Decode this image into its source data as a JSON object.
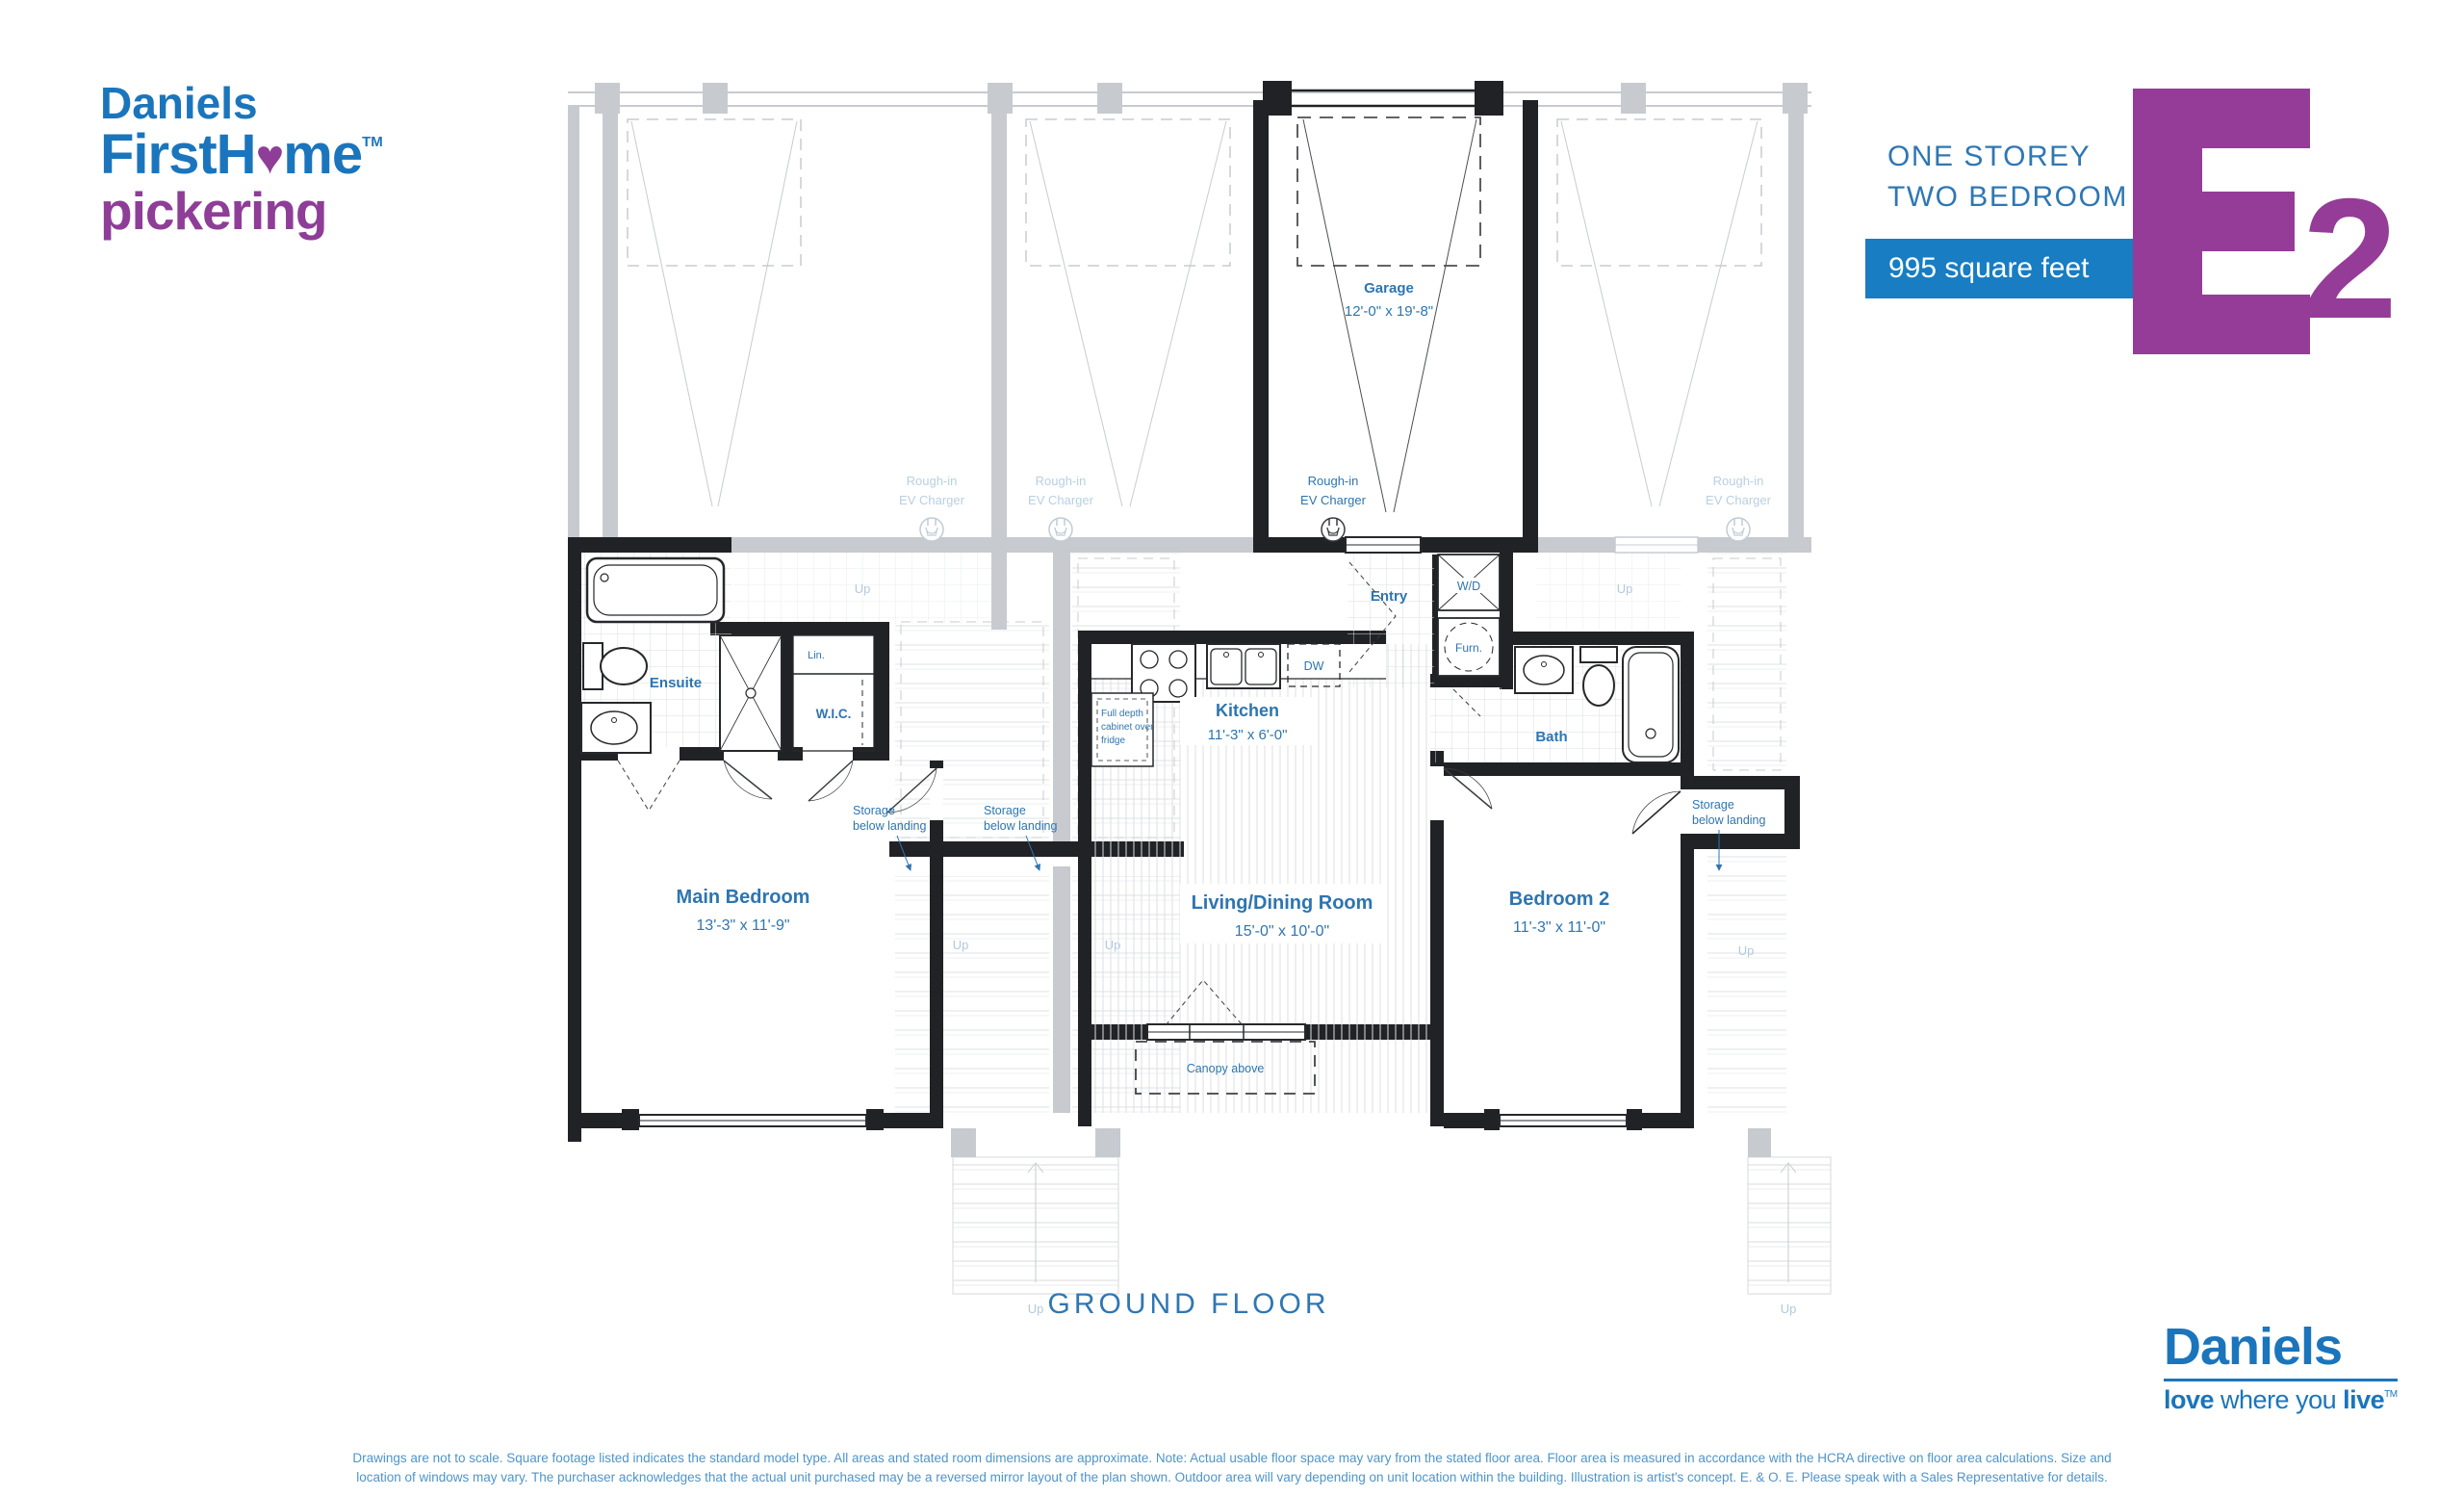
{
  "colors": {
    "brand_blue": "#1b75bc",
    "brand_purple": "#8e3e97",
    "model_purple": "#943c97",
    "banner_blue": "#187dc2",
    "label_blue": "#2e75b0",
    "faded_gray": "#c7cbd0",
    "wall_dark": "#202225"
  },
  "header": {
    "brand": {
      "line1": "Daniels",
      "line2_pre": "FirstH",
      "heart_icon": "♥",
      "line2_post": "me",
      "tm": "TM",
      "line3": "pickering"
    },
    "plan_type_line1": "ONE STOREY",
    "plan_type_line2": "TWO BEDROOM",
    "area_banner": "995 square feet",
    "model_letter": "E",
    "model_number": "2"
  },
  "floor_plan": {
    "title": "GROUND FLOOR",
    "garage": {
      "name": "Garage",
      "dims": "12'-0\" x 19'-8\""
    },
    "ev": {
      "l1": "Rough-in",
      "l2": "EV Charger"
    },
    "entry": "Entry",
    "wd": "W/D",
    "furn": "Furn.",
    "ensuite": "Ensuite",
    "lin": "Lin.",
    "wic": "W.I.C.",
    "kitchen": {
      "name": "Kitchen",
      "dims": "11'-3\" x 6'-0\""
    },
    "dw": "DW",
    "fridge_note": {
      "l1": "Full depth",
      "l2": "cabinet over",
      "l3": "fridge"
    },
    "bath": "Bath",
    "main_bedroom": {
      "name": "Main Bedroom",
      "dims": "13'-3\" x 11'-9\""
    },
    "living": {
      "name": "Living/Dining Room",
      "dims": "15'-0\" x 10'-0\""
    },
    "bedroom2": {
      "name": "Bedroom 2",
      "dims": "11'-3\" x 11'-0\""
    },
    "storage": {
      "l1": "Storage",
      "l2": "below landing"
    },
    "canopy": "Canopy above",
    "up": "Up"
  },
  "footer": {
    "logo": {
      "name": "Daniels",
      "tag_bold1": "love",
      "tag_mid": " where you ",
      "tag_bold2": "live",
      "tm": "TM"
    },
    "disclaimer_line1": "Drawings are not to scale. Square footage listed indicates the standard model type. All areas and stated room dimensions are approximate. Note: Actual usable floor space may vary from the stated floor area. Floor area is measured in accordance with the HCRA directive on floor area calculations. Size and",
    "disclaimer_line2": "location of windows may vary. The purchaser acknowledges that the actual unit purchased may be a reversed mirror layout of the plan shown. Outdoor area will vary depending on unit location within the building. Illustration is artist's concept. E. & O. E. Please speak with a Sales Representative for details."
  }
}
